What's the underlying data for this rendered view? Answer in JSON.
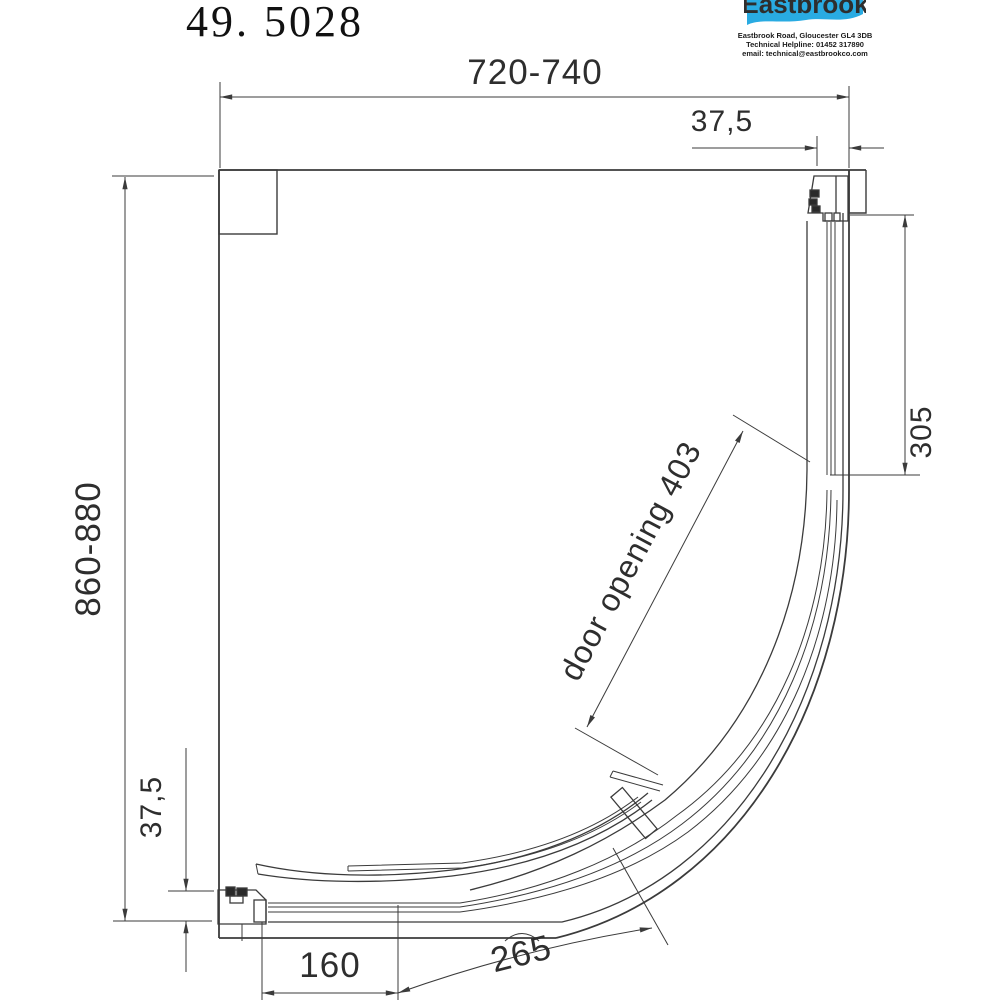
{
  "colors": {
    "ink": "#3b3b3b",
    "dim": "#3b3b3b",
    "text": "#2e2e2e",
    "brand_blue": "#29abe2",
    "paper": "#ffffff"
  },
  "title": "49. 5028",
  "logo": {
    "brand": "Eastbrook",
    "address": "Eastbrook Road, Gloucester GL4 3DB",
    "helpline": "Technical Helpline: 01452 317890",
    "email": "email: technical@eastbrookco.com"
  },
  "dimensions": {
    "width_range": "720-740",
    "top_offset": "37,5",
    "side_panel_return": "305",
    "depth_range": "860-880",
    "bottom_offset": "37,5",
    "front_return": "160",
    "curved_panel_arc": "265",
    "door_opening": "door opening 403"
  }
}
